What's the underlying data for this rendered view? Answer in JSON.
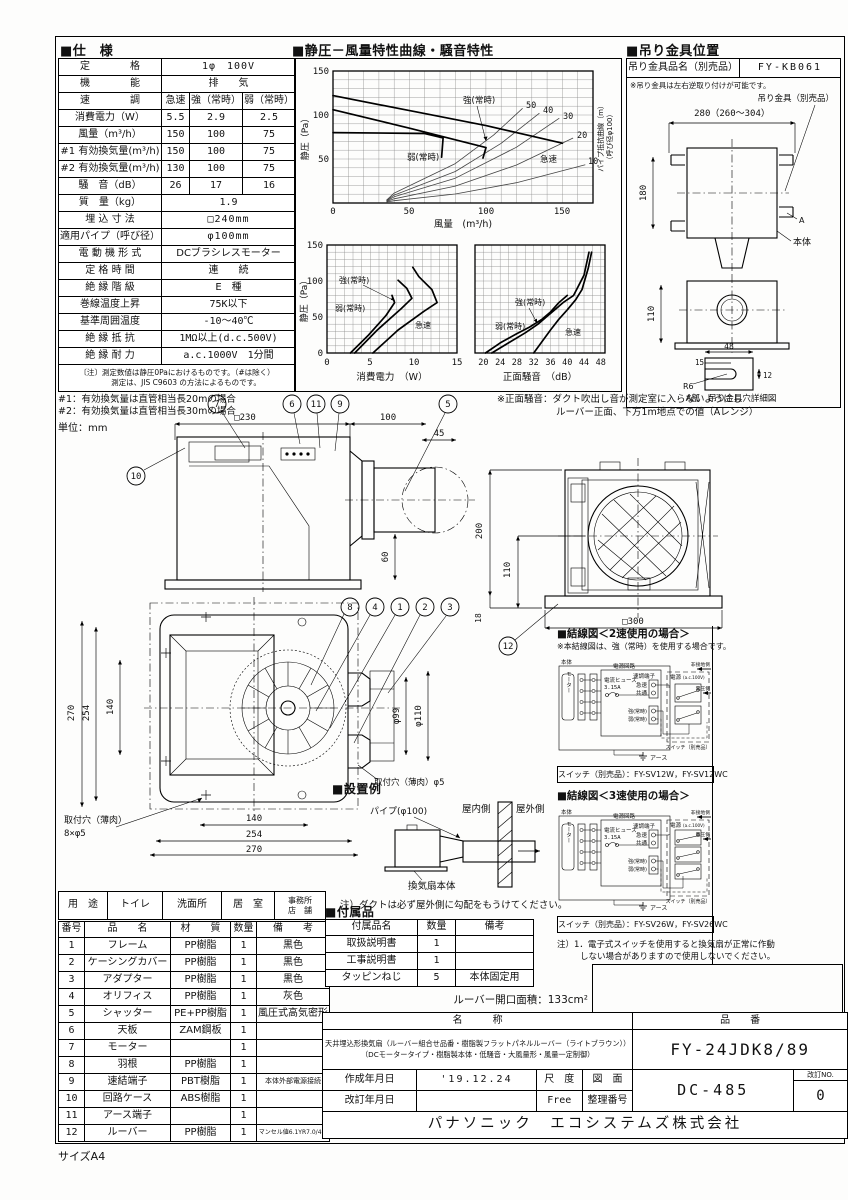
{
  "page": {
    "size_label": "サイズA4",
    "unit_note": "単位：mm"
  },
  "spec": {
    "title": "■仕　様",
    "r_rating": {
      "label": "定　　　　格",
      "value": "1φ　100V"
    },
    "r_function": {
      "label": "機　　　　能",
      "value": "排　　気"
    },
    "r_speed": {
      "label": "速　　　　調",
      "v1": "急速",
      "v2": "強（常時）",
      "v3": "弱（常時）"
    },
    "r_power": {
      "label": "消費電力（W）",
      "v1": "5.5",
      "v2": "2.9",
      "v3": "2.5"
    },
    "r_flow": {
      "label": "風量（m³/h）",
      "v1": "150",
      "v2": "100",
      "v3": "75"
    },
    "r_eff1": {
      "label": "#1 有効換気量(m³/h)",
      "v1": "150",
      "v2": "100",
      "v3": "75"
    },
    "r_eff2": {
      "label": "#2 有効換気量(m³/h)",
      "v1": "130",
      "v2": "100",
      "v3": "75"
    },
    "r_noise": {
      "label": "騒　音（dB）",
      "v1": "26",
      "v2": "17",
      "v3": "16"
    },
    "r_mass": {
      "label": "質　量（kg）",
      "value": "1.9"
    },
    "r_embed": {
      "label": "埋 込 寸 法",
      "value": "□240mm"
    },
    "r_pipe": {
      "label": "適用パイプ（呼び径）",
      "value": "φ100mm"
    },
    "r_motor": {
      "label": "電 動 機 形 式",
      "value": "DCブラシレスモーター"
    },
    "r_time": {
      "label": "定 格 時 間",
      "value": "連　　続"
    },
    "r_class": {
      "label": "絶 縁 階 級",
      "value": "E　種"
    },
    "r_temp": {
      "label": "巻線温度上昇",
      "value": "75K以下"
    },
    "r_ambient": {
      "label": "基準周囲温度",
      "value": "-10～40℃"
    },
    "r_res": {
      "label": "絶 縁 抵 抗",
      "value": "1MΩ以上(d.c.500V)"
    },
    "r_str": {
      "label": "絶 縁 耐 力",
      "value": "a.c.1000V　1分間"
    },
    "note1": "〔注〕測定数値は静圧0Paにおけるものです。（#は除く）",
    "note2": "測定は、JIS C9603 の方法によるものです。",
    "fn1": "#1：有効換気量は直管相当長20mの場合",
    "fn2": "#2：有効換気量は直管相当長30mの場合"
  },
  "charts": {
    "title": "■静圧－風量特性曲線・騒音特性",
    "pq": {
      "ylabel": "静圧（Pa）",
      "xlabel": "風量　(m³/h)",
      "right1": "パイプ抵抗曲線（m）",
      "right2": "（呼び径φ100）",
      "lbl_strong": "強(常時)",
      "lbl_weak": "弱(常時)",
      "lbl_rapid": "急速",
      "pipe": [
        "50",
        "40",
        "30",
        "20",
        "10"
      ],
      "xt": [
        "0",
        "50",
        "100",
        "150"
      ],
      "yt": [
        "150",
        "100",
        "50"
      ]
    },
    "power": {
      "xlabel": "消費電力　（W）",
      "ylabel": "静圧（Pa）",
      "xt": [
        "0",
        "5",
        "10",
        "15"
      ],
      "yt": [
        "150",
        "100",
        "50",
        "0"
      ],
      "lbl_strong": "強(常時)",
      "lbl_weak": "弱(常時)",
      "lbl_rapid": "急速"
    },
    "noise": {
      "xlabel": "正面騒音　（dB）",
      "xt": [
        "20",
        "24",
        "28",
        "32",
        "36",
        "40",
        "44",
        "48"
      ],
      "lbl_strong": "強(常時)",
      "lbl_weak": "弱(常時)",
      "lbl_rapid": "急速"
    }
  },
  "chart_data": [
    {
      "type": "line",
      "title": "静圧-風量特性曲線",
      "xlabel": "風量 (m³/h)",
      "ylabel": "静圧 (Pa)",
      "xlim": [
        0,
        170
      ],
      "ylim": [
        0,
        150
      ],
      "grid": true,
      "series": [
        {
          "name": "急速",
          "points": [
            [
              0,
              122
            ],
            [
              50,
              105
            ],
            [
              100,
              88
            ],
            [
              150,
              68
            ]
          ]
        },
        {
          "name": "強(常時)",
          "points": [
            [
              0,
              106
            ],
            [
              50,
              85
            ],
            [
              100,
              63
            ]
          ]
        },
        {
          "name": "弱(常時)",
          "points": [
            [
              0,
              80
            ],
            [
              60,
              79
            ],
            [
              72,
              74
            ],
            [
              71,
              52
            ]
          ]
        },
        {
          "name": "パイプ抵抗曲線10m",
          "points": [
            [
              40,
              2.6
            ],
            [
              80,
              10.2
            ],
            [
              120,
              23
            ],
            [
              165,
              43.6
            ]
          ]
        },
        {
          "name": "パイプ抵抗曲線20m",
          "points": [
            [
              40,
              4.8
            ],
            [
              80,
              19.2
            ],
            [
              120,
              43.2
            ],
            [
              157,
              73.9
            ]
          ]
        },
        {
          "name": "パイプ抵抗曲線30m",
          "points": [
            [
              40,
              7
            ],
            [
              80,
              28.2
            ],
            [
              120,
              63.4
            ],
            [
              148,
              96.4
            ]
          ]
        },
        {
          "name": "パイプ抵抗曲線40m",
          "points": [
            [
              40,
              9
            ],
            [
              80,
              35.8
            ],
            [
              110,
              67.8
            ],
            [
              135,
              102
            ]
          ]
        },
        {
          "name": "パイプ抵抗曲線50m",
          "points": [
            [
              40,
              11.2
            ],
            [
              80,
              44.8
            ],
            [
              105,
              77.2
            ],
            [
              124,
              107.6
            ]
          ]
        }
      ]
    },
    {
      "type": "line",
      "title": "静圧-消費電力特性",
      "xlabel": "消費電力 (W)",
      "ylabel": "静圧 (Pa)",
      "xlim": [
        0,
        15
      ],
      "ylim": [
        0,
        150
      ],
      "series": [
        {
          "name": "急速",
          "points": [
            [
              5.3,
              0
            ],
            [
              8.2,
              32
            ],
            [
              11.2,
              58
            ],
            [
              12.7,
              70
            ],
            [
              12.1,
              88
            ],
            [
              10.6,
              106
            ],
            [
              9.9,
              118
            ]
          ]
        },
        {
          "name": "強(常時)",
          "points": [
            [
              3.2,
              0
            ],
            [
              5.8,
              32
            ],
            [
              8.6,
              62
            ],
            [
              9.8,
              76
            ],
            [
              9.2,
              90
            ],
            [
              8.2,
              101
            ]
          ]
        },
        {
          "name": "弱(常時)",
          "points": [
            [
              2.7,
              0
            ],
            [
              4.8,
              25
            ],
            [
              6.8,
              52
            ],
            [
              7.8,
              70
            ],
            [
              7.5,
              80
            ]
          ]
        }
      ]
    },
    {
      "type": "line",
      "title": "静圧-正面騒音特性",
      "xlabel": "正面騒音 (dB)",
      "ylabel": "静圧 (Pa)",
      "xlim": [
        20,
        48
      ],
      "ylim": [
        0,
        150
      ],
      "series": [
        {
          "name": "急速",
          "points": [
            [
              32,
              0
            ],
            [
              36,
              32
            ],
            [
              40,
              60
            ],
            [
              43.5,
              88
            ],
            [
              45,
              118
            ],
            [
              45.8,
              140
            ]
          ]
        },
        {
          "name": "強(常時)",
          "points": [
            [
              22,
              0
            ],
            [
              30,
              28
            ],
            [
              35,
              50
            ],
            [
              39,
              70
            ],
            [
              44,
              108
            ],
            [
              45.2,
              140
            ]
          ]
        },
        {
          "name": "弱(常時)",
          "points": [
            [
              20.5,
              0
            ],
            [
              28,
              27
            ],
            [
              34,
              47
            ],
            [
              38,
              70
            ],
            [
              40,
              80
            ]
          ]
        }
      ]
    }
  ],
  "bracket": {
    "title": "■吊り金具位置",
    "name_label": "吊り金具品名（別売品）",
    "name_value": "FY-KB061",
    "note": "※吊り金具は左右逆取り付けが可能です。",
    "part_label": "吊り金具（別売品）",
    "dim_width": "280（260～304）",
    "dim_height": "180",
    "dim_height2": "110",
    "lbl_a": "A",
    "lbl_body": "本体",
    "d48": "48",
    "d15": "15",
    "d12": "12",
    "r6": "R6",
    "caption": "A部　吊り金具穴詳細図"
  },
  "noise_note": {
    "line1": "※正面騒音：ダクト吹出し音が測定室に入らないようにし",
    "line2": "ルーバー正面、下方1m地点での値（Aレンジ）"
  },
  "drawings": {
    "side": {
      "c7": "7",
      "c6": "6",
      "c11": "11",
      "c9": "9",
      "c5": "5",
      "c10": "10",
      "d230": "□230",
      "d100": "100",
      "d45": "45",
      "d60": "60"
    },
    "rear": {
      "c12": "12",
      "d200": "200",
      "d110": "110",
      "d300": "□300",
      "d18": "18"
    },
    "front": {
      "c8": "8",
      "c4": "4",
      "c1": "1",
      "c2": "2",
      "c3": "3",
      "dv270": "270",
      "dv254": "254",
      "dv140": "140",
      "dh140": "140",
      "dh254": "254",
      "dh270": "270",
      "p99": "φ99",
      "p110": "φ110",
      "hole_r": "取付穴（薄肉）φ5",
      "hole_l1": "取付穴（薄肉）",
      "hole_l2": "8×φ5"
    },
    "install": {
      "title": "■設置例",
      "pipe": "パイプ(φ100)",
      "indoor": "屋内側",
      "outdoor": "屋外側",
      "body": "換気扇本体",
      "note": "注）ダクトは必ず屋外側に勾配をもうけてください。"
    }
  },
  "wiring": {
    "labels": {
      "body": "本体",
      "motor": "モーター",
      "circuit": "電源回路",
      "fuse1": "電流ヒューズ",
      "fuse2": "3.15A",
      "terminal": "速調端子",
      "fast": "急速",
      "common": "共通",
      "strong": "強(常時)",
      "weak": "弱(常時)",
      "power": "電源",
      "power_v": "(a.c.100V)",
      "nonground": "非接地側",
      "voltage": "電圧側",
      "switch": "スイッチ（別売品）",
      "earth": "アース"
    },
    "d2": {
      "title": "■結線図＜2速使用の場合＞",
      "note": "※本結線図は、強（常時）を使用する場合です。",
      "switch_models": "スイッチ（別売品）：FY-SV12W，FY-SV12WC"
    },
    "d3": {
      "title": "■結線図＜3速使用の場合＞",
      "switch_models": "スイッチ（別売品）：FY-SV26W，FY-SV26WC",
      "note1": "注）1．電子式スイッチを使用すると換気扇が正常に作動",
      "note2": "しない場合がありますので使用しないでください。"
    }
  },
  "usage": {
    "header": "用　途",
    "i1": "トイレ",
    "i2": "洗面所",
    "i3": "居　室",
    "i4a": "事務所",
    "i4b": "店　舗"
  },
  "parts": {
    "h_no": "番号",
    "h_name": "品　　名",
    "h_mat": "材　　質",
    "h_qty": "数量",
    "h_rem": "備　　考",
    "rows": [
      {
        "no": "1",
        "name": "フレーム",
        "mat": "PP樹脂",
        "qty": "1",
        "rem": "黒色"
      },
      {
        "no": "2",
        "name": "ケーシングカバー",
        "mat": "PP樹脂",
        "qty": "1",
        "rem": "黒色"
      },
      {
        "no": "3",
        "name": "アダプター",
        "mat": "PP樹脂",
        "qty": "1",
        "rem": "黒色"
      },
      {
        "no": "4",
        "name": "オリフィス",
        "mat": "PP樹脂",
        "qty": "1",
        "rem": "灰色"
      },
      {
        "no": "5",
        "name": "シャッター",
        "mat": "PE+PP樹脂",
        "qty": "1",
        "rem": "風圧式高気密形"
      },
      {
        "no": "6",
        "name": "天板",
        "mat": "ZAM鋼板",
        "qty": "1",
        "rem": ""
      },
      {
        "no": "7",
        "name": "モーター",
        "mat": "",
        "qty": "1",
        "rem": ""
      },
      {
        "no": "8",
        "name": "羽根",
        "mat": "PP樹脂",
        "qty": "1",
        "rem": ""
      },
      {
        "no": "9",
        "name": "速結端子",
        "mat": "PBT樹脂",
        "qty": "1",
        "rem": "本体外部電源接続"
      },
      {
        "no": "10",
        "name": "回路ケース",
        "mat": "ABS樹脂",
        "qty": "1",
        "rem": ""
      },
      {
        "no": "11",
        "name": "アース端子",
        "mat": "",
        "qty": "1",
        "rem": ""
      },
      {
        "no": "12",
        "name": "ルーバー",
        "mat": "PP樹脂",
        "qty": "1",
        "rem": "マンセル値6.1YR7.0/4.0"
      }
    ]
  },
  "accessories": {
    "title": "■付属品",
    "h_name": "付属品名",
    "h_qty": "数量",
    "h_rem": "備考",
    "rows": [
      {
        "name": "取扱説明書",
        "qty": "1",
        "rem": ""
      },
      {
        "name": "工事説明書",
        "qty": "1",
        "rem": ""
      },
      {
        "name": "タッピンねじ",
        "qty": "5",
        "rem": "本体固定用"
      }
    ],
    "opening": "ルーバー開口面積：133cm²"
  },
  "titleblock": {
    "h_name": "名　　　称",
    "h_pn": "品　　番",
    "name1": "天井埋込形換気扇（ルーバー組合せ品番・樹脂製フラットパネルルーバー（ライトブラウン））",
    "name2": "（DCモータータイプ・樹脂製本体・低騒音・大風量形・風量一定制御）",
    "pn": "FY-24JDK8/89",
    "created_label": "作成年月日",
    "created": "'19.12.24",
    "revised_label": "改訂年月日",
    "revised": "",
    "scale_label": "尺　度",
    "scale": "Free",
    "dwg_label": "図　面",
    "no_label": "整理番号",
    "dwg_no": "DC-485",
    "rev_label": "改訂NO.",
    "rev_no": "0",
    "company": "パナソニック　エコシステムズ株式会社"
  }
}
